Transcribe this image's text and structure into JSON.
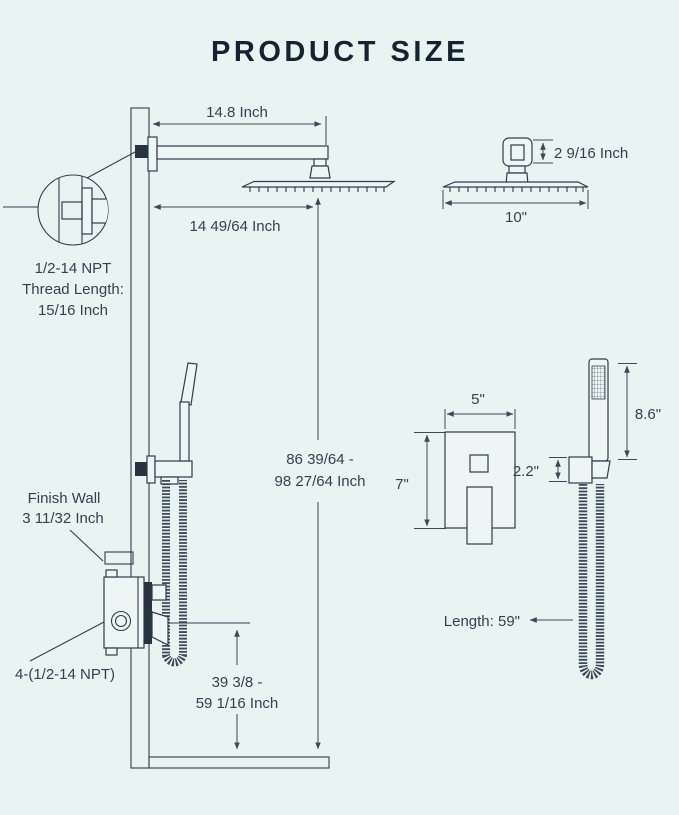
{
  "title": "PRODUCT SIZE",
  "colors": {
    "background": "#e9f4f2",
    "ink": "#2e3d4c",
    "title": "#152330",
    "dark_fill": "#27333f"
  },
  "labels": {
    "arm_length": "14.8 Inch",
    "head_center_offset": "14 49/64 Inch",
    "thread_spec": {
      "line1": "1/2-14 NPT",
      "line2": "Thread Length:",
      "line3": "15/16 Inch"
    },
    "overall_height": {
      "line1": "86 39/64 -",
      "line2": "98 27/64 Inch"
    },
    "finish_wall": {
      "line1": "Finish Wall",
      "line2": "3 11/32 Inch"
    },
    "valve_ports": "4-(1/2-14 NPT)",
    "handheld_height": {
      "line1": "39 3/8 -",
      "line2": "59 1/16 Inch"
    },
    "head_side": {
      "bracket_height": "2 9/16 Inch",
      "width": "10\""
    },
    "valve_trim": {
      "width": "5\"",
      "height": "7\""
    },
    "handheld": {
      "wand_length": "8.6\"",
      "holder_height": "2.2\"",
      "hose_length": "Length: 59\""
    }
  }
}
